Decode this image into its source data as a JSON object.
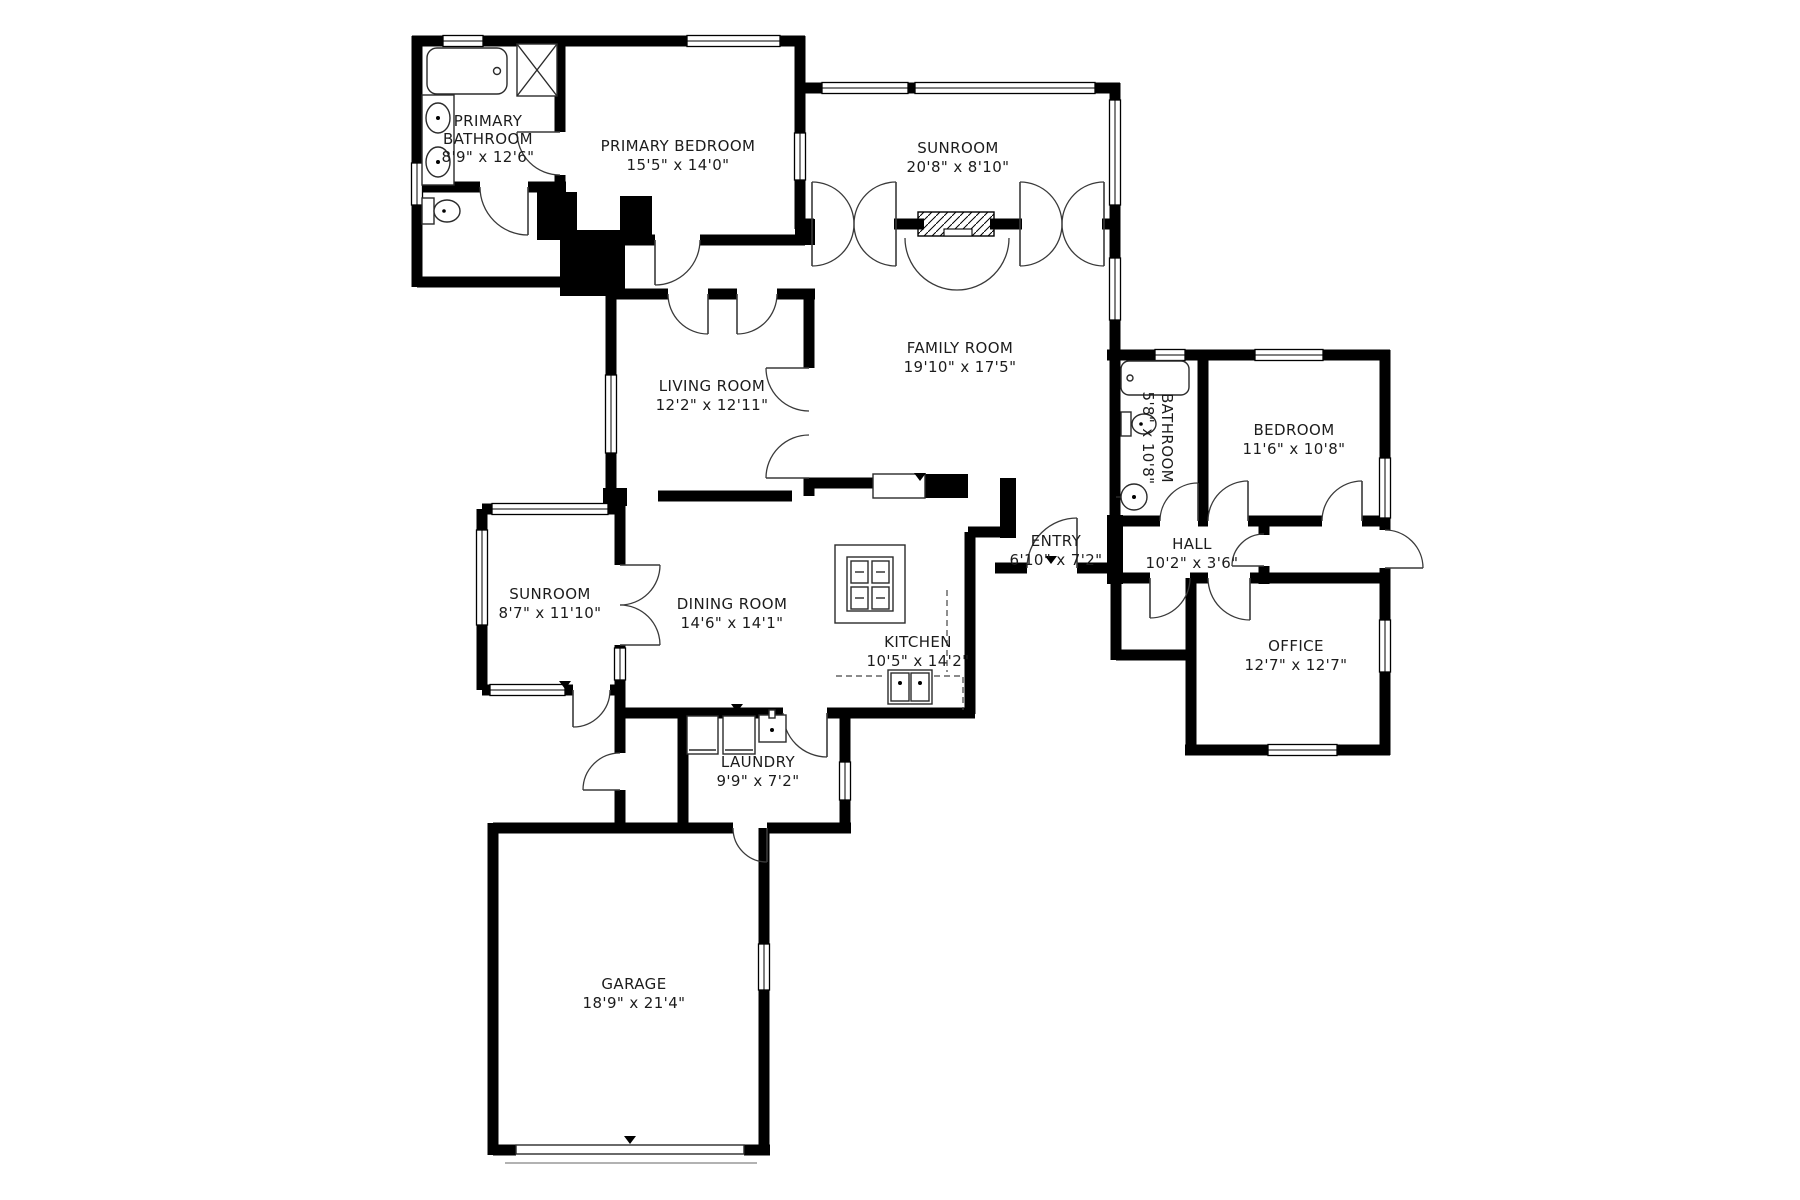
{
  "title": "House floor plan",
  "colors": {
    "wall": "#000000",
    "background": "#ffffff",
    "text": "#1c1c1c"
  },
  "rooms": [
    {
      "id": "primary-bathroom",
      "line1": "PRIMARY",
      "line2": "BATHROOM",
      "line3": "8'9\" x 12'6\""
    },
    {
      "id": "primary-bedroom",
      "line1": "PRIMARY BEDROOM",
      "line2": "15'5\" x 14'0\""
    },
    {
      "id": "sunroom-top",
      "line1": "SUNROOM",
      "line2": "20'8\" x 8'10\""
    },
    {
      "id": "family-room",
      "line1": "FAMILY ROOM",
      "line2": "19'10\" x 17'5\""
    },
    {
      "id": "living-room",
      "line1": "LIVING ROOM",
      "line2": "12'2\" x 12'11\""
    },
    {
      "id": "bathroom",
      "line1": "BATHROOM",
      "line2": "5'8\" x 10'8\""
    },
    {
      "id": "bedroom",
      "line1": "BEDROOM",
      "line2": "11'6\" x 10'8\""
    },
    {
      "id": "hall",
      "line1": "HALL",
      "line2": "10'2\" x 3'6\""
    },
    {
      "id": "entry",
      "line1": "ENTRY",
      "line2": "6'10\" x 7'2\""
    },
    {
      "id": "office",
      "line1": "OFFICE",
      "line2": "12'7\" x 12'7\""
    },
    {
      "id": "sunroom-left",
      "line1": "SUNROOM",
      "line2": "8'7\" x 11'10\""
    },
    {
      "id": "dining-room",
      "line1": "DINING ROOM",
      "line2": "14'6\" x 14'1\""
    },
    {
      "id": "kitchen",
      "line1": "KITCHEN",
      "line2": "10'5\" x 14'2\""
    },
    {
      "id": "laundry",
      "line1": "LAUNDRY",
      "line2": "9'9\" x 7'2\""
    },
    {
      "id": "garage",
      "line1": "GARAGE",
      "line2": "18'9\" x 21'4\""
    }
  ]
}
